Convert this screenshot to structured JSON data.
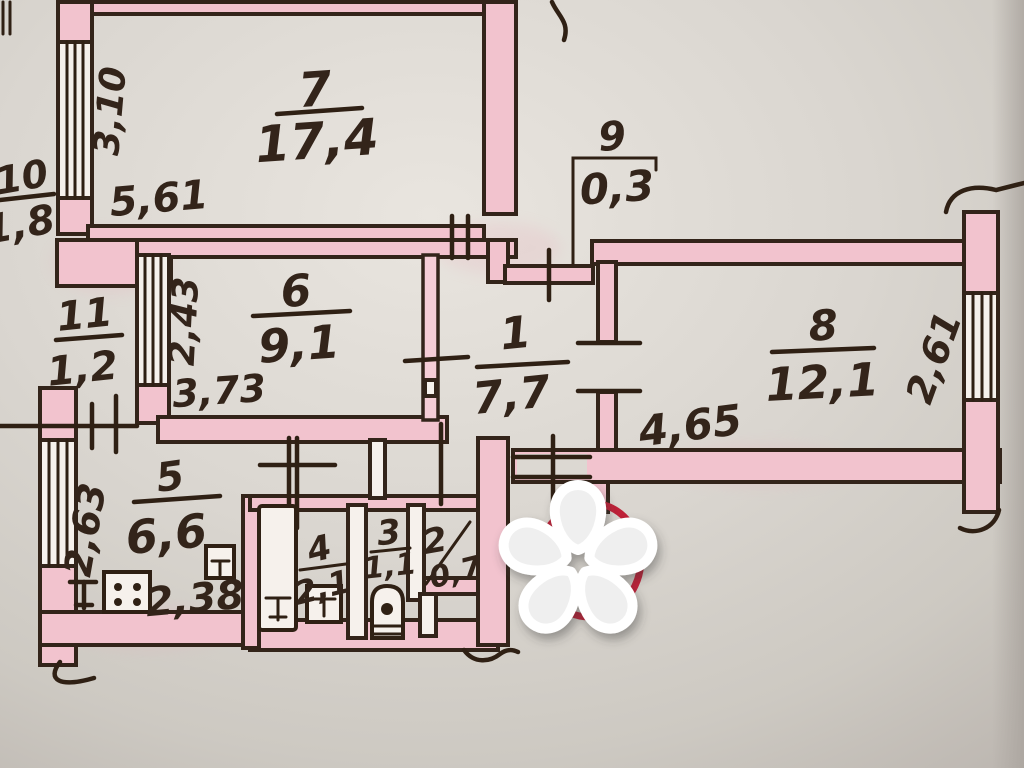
{
  "plan": {
    "description": "hand-drawn apartment floor plan photo",
    "rooms": [
      {
        "id": "1",
        "area": "7,7"
      },
      {
        "id": "2",
        "area": "0,7"
      },
      {
        "id": "3",
        "area": "1,1"
      },
      {
        "id": "4",
        "area": "2,1"
      },
      {
        "id": "5",
        "area": "6,6"
      },
      {
        "id": "6",
        "area": "9,1"
      },
      {
        "id": "7",
        "area": "17,4"
      },
      {
        "id": "8",
        "area": "12,1"
      },
      {
        "id": "9",
        "area": "0,3"
      },
      {
        "id": "10",
        "area": "1,8"
      },
      {
        "id": "11",
        "area": "1,2"
      }
    ],
    "dims": {
      "room7_h": "3,10",
      "room7_w": "5,61",
      "room6_h": "2,43",
      "room6_w": "3,73",
      "room5_h": "2,63",
      "room5_w": "2,38",
      "room8_w": "4,65",
      "room8_h": "2,61"
    },
    "colors": {
      "walls": "#f2c3ce",
      "ink": "#33241a",
      "paper": "#d9d5cf",
      "entrance_mark": "#bf2138",
      "watermark_petal_light": "#eeeeee",
      "watermark_petal_dark": "#4a4a4a"
    },
    "icons": {
      "watermark": "asterisk-flower-watermark",
      "fixtures": [
        "stove-icon",
        "kitchen-sink-icon",
        "bathtub-icon",
        "washbasin-icon",
        "toilet-icon"
      ],
      "marks": [
        "entrance-red-circle",
        "door-tick-marks",
        "window-bands",
        "wall-break-squiggles"
      ]
    }
  }
}
